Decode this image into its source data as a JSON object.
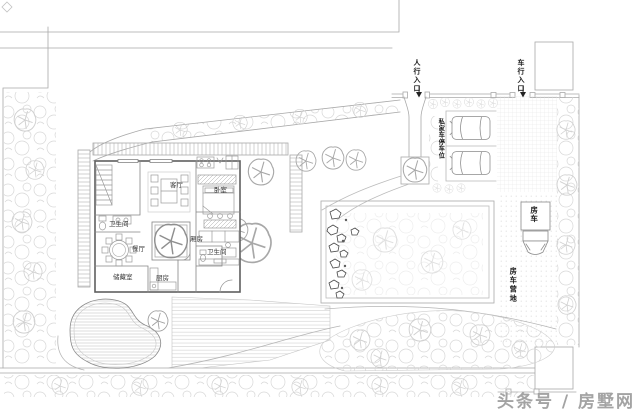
{
  "site": {
    "pedestrian_entrance": "人行入口",
    "vehicle_entrance": "车行入口",
    "private_parking": "私家车停车位",
    "rv": "房车",
    "rv_camp": "房车营地"
  },
  "rooms": {
    "living_room": "客厅",
    "bedroom": "卧室",
    "bathroom_1": "卫生间",
    "dining_room": "餐厅",
    "wing_room": "厢房",
    "bathroom_2": "卫生间",
    "storage_room": "储藏室",
    "kitchen": "厨房"
  },
  "watermark": "头条号 / 房墅网",
  "colors": {
    "line": "#a9a9a9",
    "wall": "#5f5f5f",
    "texture": "#d6d6d6",
    "rock": "#4a4a4a",
    "label_text": "#1b1b1b",
    "watermark_gray": "#a3a3a3",
    "background": "#ffffff"
  }
}
